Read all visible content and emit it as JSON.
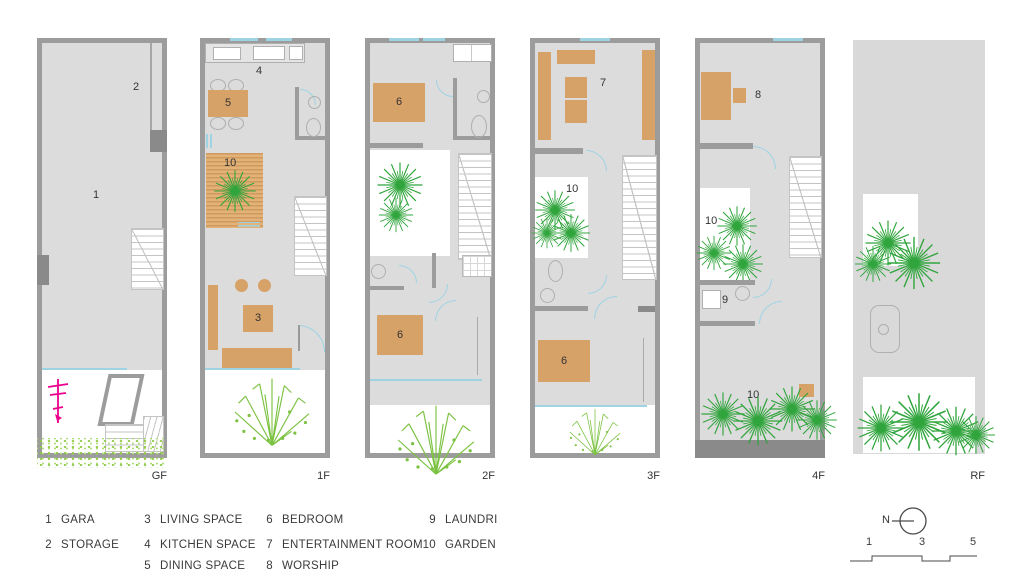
{
  "floors": [
    {
      "label": "GF",
      "rooms": {
        "gara": "1",
        "storage": "2"
      }
    },
    {
      "label": "1F",
      "rooms": {
        "living": "3",
        "kitchen": "4",
        "dining": "5",
        "deck_garden": "10"
      }
    },
    {
      "label": "2F",
      "rooms": {
        "bedroom_front": "6",
        "bedroom_back": "6"
      }
    },
    {
      "label": "3F",
      "rooms": {
        "entertainment": "7",
        "garden": "10",
        "bedroom": "6"
      }
    },
    {
      "label": "4F",
      "rooms": {
        "worship": "8",
        "garden_upper": "10",
        "laundry": "9",
        "garden_terrace": "10"
      }
    },
    {
      "label": "RF",
      "rooms": {}
    }
  ],
  "legend": {
    "columns": [
      {
        "items": [
          {
            "num": "1",
            "label": "GARA"
          },
          {
            "num": "2",
            "label": "STORAGE"
          }
        ]
      },
      {
        "items": [
          {
            "num": "3",
            "label": "LIVING SPACE"
          },
          {
            "num": "4",
            "label": "KITCHEN SPACE"
          },
          {
            "num": "5",
            "label": "DINING SPACE"
          }
        ]
      },
      {
        "items": [
          {
            "num": "6",
            "label": "BEDROOM"
          },
          {
            "num": "7",
            "label": "ENTERTAINMENT ROOM"
          },
          {
            "num": "8",
            "label": "WORSHIP"
          }
        ]
      },
      {
        "items": [
          {
            "num": "9",
            "label": "LAUNDRI"
          },
          {
            "num": "10",
            "label": "GARDEN"
          }
        ]
      }
    ]
  },
  "compass": {
    "label": "N"
  },
  "scale_bar": {
    "ticks": [
      "1",
      "3",
      "5"
    ]
  },
  "colors": {
    "furniture_tan": "#d7a268",
    "tree_green": "#31a53d",
    "spread_green": "#7cc242",
    "door_swing_cyan": "#9ed3e4",
    "wall_gray": "#9c9c9c",
    "floor_gray": "#dcdcdc",
    "accent_magenta": "#ec008c"
  }
}
